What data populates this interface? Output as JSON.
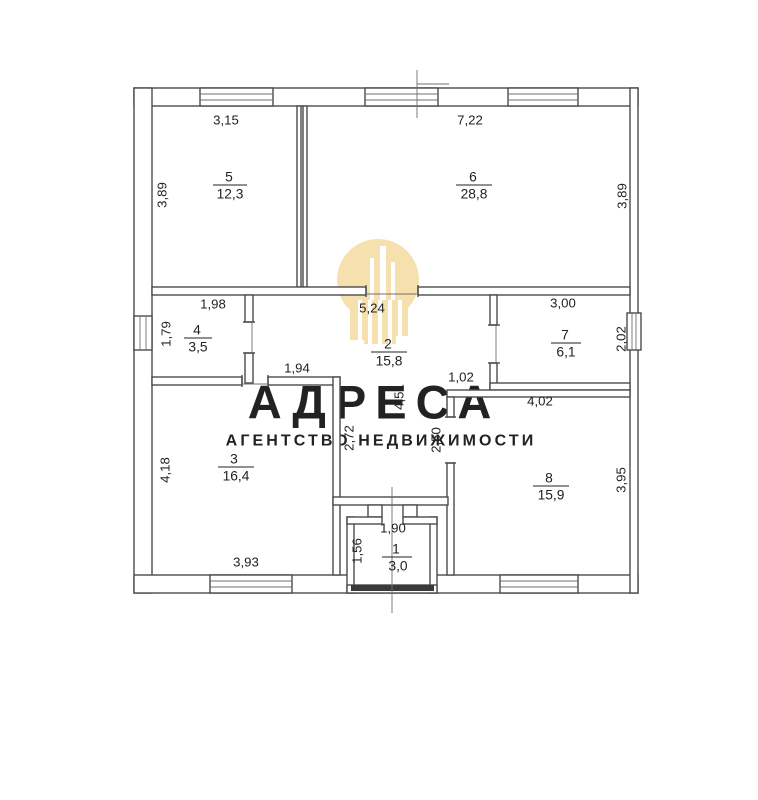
{
  "watermark": {
    "brand": "АДРЕСА",
    "tagline": "АГЕНТСТВО НЕДВИЖИМОСТИ",
    "brand_color": "#f3dcab",
    "tagline_color": "#f6e8c7",
    "logo_color": "#f6e0ae"
  },
  "plan": {
    "rooms": {
      "r1": {
        "number": "1",
        "area": "3,0"
      },
      "r2": {
        "number": "2",
        "area": "15,8"
      },
      "r3": {
        "number": "3",
        "area": "16,4"
      },
      "r4": {
        "number": "4",
        "area": "3,5"
      },
      "r5": {
        "number": "5",
        "area": "12,3"
      },
      "r6": {
        "number": "6",
        "area": "28,8"
      },
      "r7": {
        "number": "7",
        "area": "6,1"
      },
      "r8": {
        "number": "8",
        "area": "15,9"
      }
    },
    "dims": {
      "room5_top": "3,15",
      "room5_left": "3,89",
      "room6_top": "7,22",
      "room6_right": "3,89",
      "room4_top": "1,98",
      "room4_left": "1,79",
      "corridor_top": "5,24",
      "room7_top": "3,00",
      "room7_right": "2,02",
      "corridor_neck": "1,94",
      "corridor_step": "1,02",
      "corridor_mid_v": "4,51",
      "corridor_left_v": "2,72",
      "corridor_right_v": "2,50",
      "room8_top": "4,02",
      "room8_right": "3,95",
      "room3_left": "4,18",
      "room3_bottom": "3,93",
      "room1_top": "1,90",
      "room1_left": "1,56"
    },
    "colors": {
      "wall": "#4b4b4b",
      "label": "#222222",
      "background": "#ffffff"
    }
  }
}
